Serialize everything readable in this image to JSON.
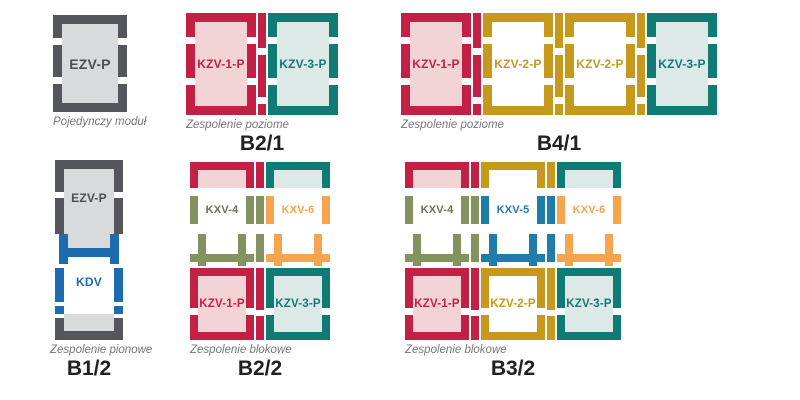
{
  "colors": {
    "red": "#c22045",
    "pink": "#f2d4d6",
    "teal": "#0f7b74",
    "teal-light": "#dce9e7",
    "gold": "#c6991d",
    "gray-dark": "#54565b",
    "gray-light": "#d9dadc",
    "gray-text": "#4d4f53",
    "green": "#83925f",
    "green-text": "#6b7355",
    "orange": "#f4a54e",
    "blue-kdv": "#1d6cb0",
    "blue-kxv5": "#1f7ea9",
    "caption": "#76777a",
    "title": "#202124",
    "white": "#ffffff"
  },
  "diagrams": {
    "single": {
      "caption": "Pojedynczy moduł",
      "modules": [
        {
          "code": "EZV-P"
        }
      ]
    },
    "b21": {
      "title": "B2/1",
      "caption": "Zespolenie poziome",
      "modules": [
        {
          "code": "KZV-1-P"
        },
        {
          "code": "KZV-3-P"
        }
      ]
    },
    "b41": {
      "title": "B4/1",
      "caption": "Zespolenie poziome",
      "modules": [
        {
          "code": "KZV-1-P"
        },
        {
          "code": "KZV-2-P"
        },
        {
          "code": "KZV-2-P"
        },
        {
          "code": "KZV-3-P"
        }
      ]
    },
    "b12": {
      "title": "B1/2",
      "caption": "Zespolenie pionowe",
      "modules": [
        {
          "code": "EZV-P"
        },
        {
          "code": "KDV"
        }
      ]
    },
    "b22": {
      "title": "B2/2",
      "caption": "Zespolenie blokowe",
      "top_modules": [
        {
          "code": "KXV-4"
        },
        {
          "code": "KXV-6"
        }
      ],
      "bottom_modules": [
        {
          "code": "KZV-1-P"
        },
        {
          "code": "KZV-3-P"
        }
      ]
    },
    "b32": {
      "title": "B3/2",
      "caption": "Zespolenie blokowe",
      "top_modules": [
        {
          "code": "KXV-4"
        },
        {
          "code": "KXV-5"
        },
        {
          "code": "KXV-6"
        }
      ],
      "bottom_modules": [
        {
          "code": "KZV-1-P"
        },
        {
          "code": "KZV-2-P"
        },
        {
          "code": "KZV-3-P"
        }
      ]
    }
  }
}
